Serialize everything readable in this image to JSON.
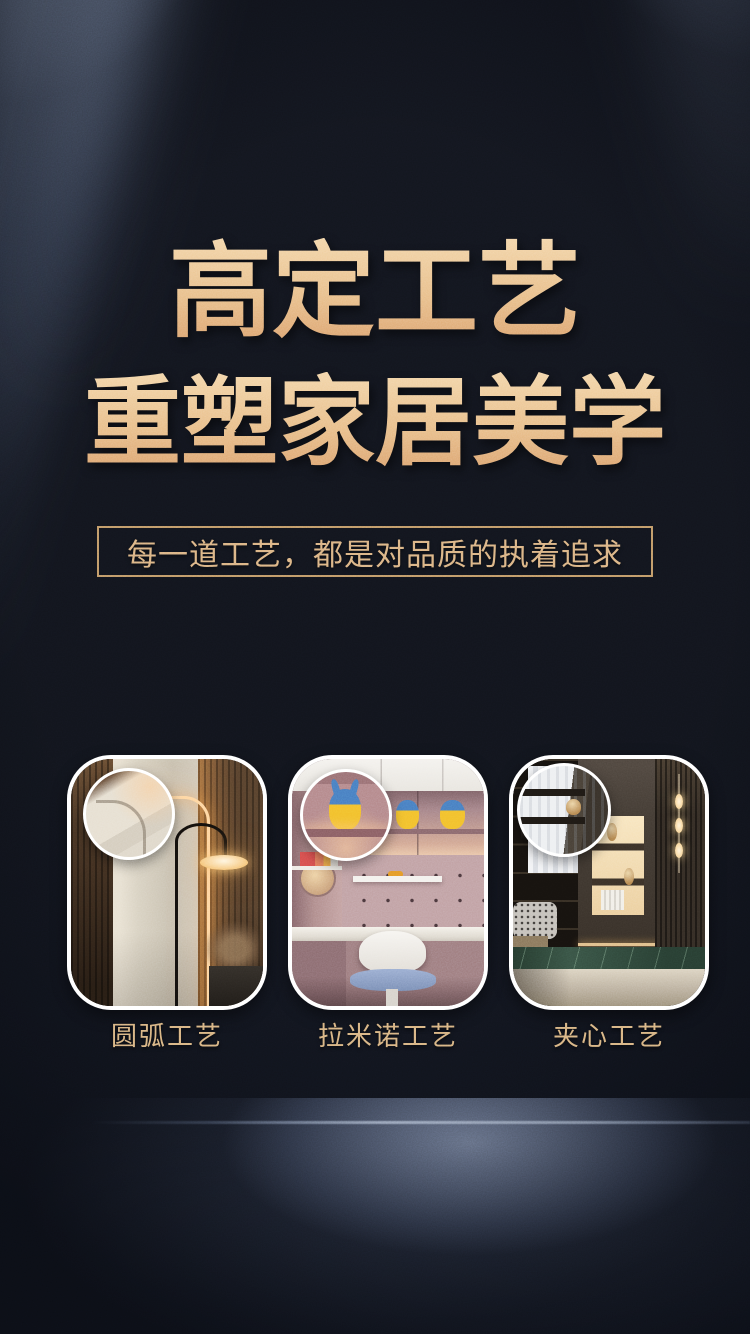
{
  "hero": {
    "title_line1": "高定工艺",
    "title_line2": "重塑家居美学",
    "subtitle": "每一道工艺，都是对品质的执着追求"
  },
  "cards": [
    {
      "caption": "圆弧工艺",
      "photo": "bedroom-rounded-corner-panel-scene",
      "magnifier_icon": "zoom-circle-icon"
    },
    {
      "caption": "拉米诺工艺",
      "photo": "kids-study-cabinet-scene",
      "magnifier_icon": "zoom-circle-icon"
    },
    {
      "caption": "夹心工艺",
      "photo": "luxury-display-wall-scene",
      "magnifier_icon": "zoom-circle-icon"
    }
  ],
  "colors": {
    "background": "#12151d",
    "title_gold_light": "#f3d6aa",
    "title_gold_dark": "#dca470",
    "subtitle_gold": "#dcb585",
    "box_border_gold": "#c29b68",
    "caption_gold": "#d9b583",
    "card_border": "#ffffff",
    "floor_glow_blue": "#8a9ab6",
    "led_warm_glow": "#ffd7a2"
  }
}
